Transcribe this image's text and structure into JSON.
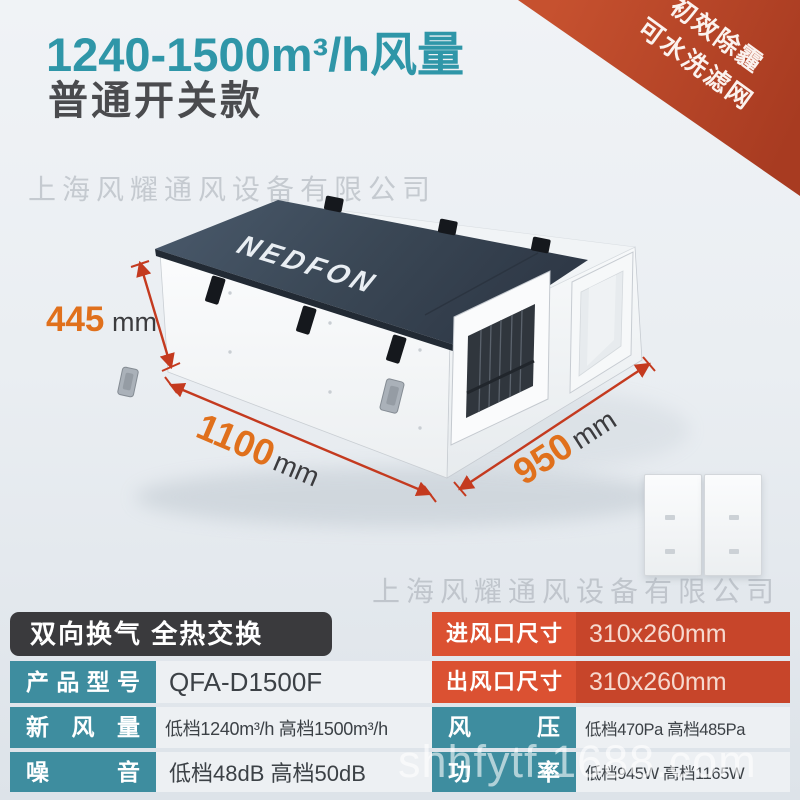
{
  "header": {
    "title": "1240-1500m³/h风量",
    "subtitle": "普通开关款"
  },
  "ribbon": {
    "line1": "初效除霾",
    "line2": "可水洗滤网",
    "color": "#b8442a"
  },
  "watermarks": {
    "company_top": "上海风耀通风设备有限公司",
    "company_middle": "上海风耀通风设备有限公司",
    "site": "shhfytf.1688.com"
  },
  "product": {
    "brand": "NEDFON",
    "dimensions": {
      "height": {
        "value": "445",
        "unit": "mm"
      },
      "length": {
        "value": "1100",
        "unit": "mm"
      },
      "depth": {
        "value": "950",
        "unit": "mm"
      }
    },
    "arrow_color": "#c43a1f",
    "number_color": "#e0701c"
  },
  "spec_left": {
    "header": "双向换气 全热交换",
    "rows": [
      {
        "label": "产品型号",
        "value": "QFA-D1500F"
      },
      {
        "label": "新风量",
        "value": "低档1240m³/h 高档1500m³/h"
      },
      {
        "label": "噪音",
        "value": "低档48dB 高档50dB"
      }
    ]
  },
  "spec_right": {
    "rows": [
      {
        "label": "进风口尺寸",
        "value": "310x260mm"
      },
      {
        "label": "出风口尺寸",
        "value": "310x260mm"
      },
      {
        "label": "风压",
        "value": "低档470Pa 高档485Pa"
      },
      {
        "label": "功率",
        "value": "低档945W 高档1165W"
      }
    ]
  },
  "colors": {
    "title_teal": "#2f96a8",
    "label_teal": "#3e8d9f",
    "orange_label": "#db5132",
    "orange_value": "#c7452a",
    "header_dark": "#3a3a3d"
  }
}
